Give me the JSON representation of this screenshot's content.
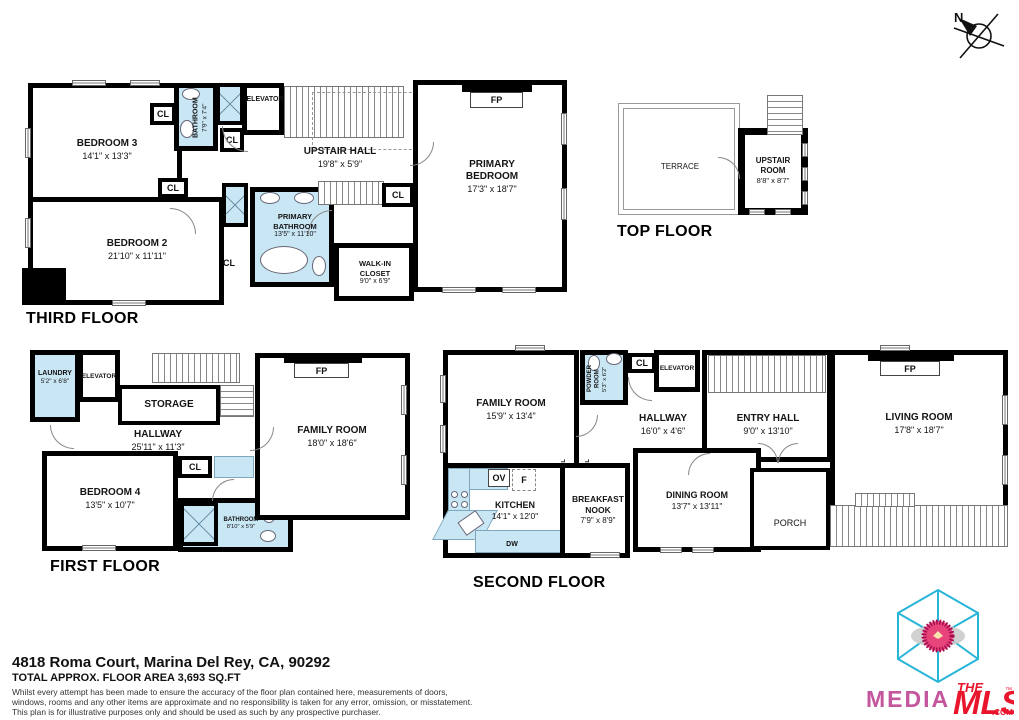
{
  "compass": {
    "label": "N"
  },
  "labels": {
    "cl": "CL",
    "fp": "FP",
    "ov": "OV",
    "f": "F",
    "dw": "DW"
  },
  "floors": {
    "third": {
      "title": "THIRD FLOOR",
      "rooms": {
        "bedroom3": {
          "name": "BEDROOM 3",
          "dims": "14'1\" x 13'3\""
        },
        "bathroom": {
          "name": "BATHROOM",
          "dims": "7'9\" x 7'4\""
        },
        "elevator": {
          "name": "ELEVATOR"
        },
        "upstair_hall": {
          "name": "UPSTAIR HALL",
          "dims": "19'8\" x 5'9\""
        },
        "primary_bedroom": {
          "name": "PRIMARY BEDROOM",
          "dims": "17'3\" x 18'7\""
        },
        "bedroom2": {
          "name": "BEDROOM 2",
          "dims": "21'10\" x 11'11\""
        },
        "primary_bathroom": {
          "name": "PRIMARY BATHROOM",
          "dims": "13'5\" x 11'10\""
        },
        "walkin_closet": {
          "name": "WALK-IN CLOSET",
          "dims": "9'0\" x 6'9\""
        }
      }
    },
    "top": {
      "title": "TOP FLOOR",
      "rooms": {
        "terrace": {
          "name": "TERRACE"
        },
        "upstair_room": {
          "name": "UPSTAIR ROOM",
          "dims": "8'8\" x 8'7\""
        }
      }
    },
    "first": {
      "title": "FIRST FLOOR",
      "rooms": {
        "laundry": {
          "name": "LAUNDRY",
          "dims": "5'2\" x 6'8\""
        },
        "elevator": {
          "name": "ELEVATOR"
        },
        "storage": {
          "name": "STORAGE"
        },
        "hallway": {
          "name": "HALLWAY",
          "dims": "25'11\" x 11'3\""
        },
        "bedroom4": {
          "name": "BEDROOM 4",
          "dims": "13'5\" x 10'7\""
        },
        "bathroom": {
          "name": "BATHROOM",
          "dims": "8'10\" x 5'9\""
        },
        "family_room": {
          "name": "FAMILY ROOM",
          "dims": "18'0\" x 18'6\""
        }
      }
    },
    "second": {
      "title": "SECOND FLOOR",
      "rooms": {
        "family_room": {
          "name": "FAMILY ROOM",
          "dims": "15'9\" x 13'4\""
        },
        "powder_room": {
          "name": "POWDER ROOM",
          "dims": "5'3\" x 6'2\""
        },
        "elevator": {
          "name": "ELEVATOR"
        },
        "hallway": {
          "name": "HALLWAY",
          "dims": "16'0\" x 4'6\""
        },
        "entry_hall": {
          "name": "ENTRY HALL",
          "dims": "9'0\" x 13'10\""
        },
        "living_room": {
          "name": "LIVING ROOM",
          "dims": "17'8\" x 18'7\""
        },
        "kitchen": {
          "name": "KITCHEN",
          "dims": "14'1\" x 12'0\""
        },
        "breakfast_nook": {
          "name": "BREAKFAST NOOK",
          "dims": "7'9\" x 8'9\""
        },
        "dining_room": {
          "name": "DINING ROOM",
          "dims": "13'7\" x 13'11\""
        },
        "porch": {
          "name": "PORCH"
        }
      }
    }
  },
  "footer": {
    "address": "4818 Roma Court, Marina Del Rey, CA, 90292",
    "area": "TOTAL APPROX. FLOOR AREA 3,693 SQ.FT",
    "disclaimer1": "Whilst every attempt has been made to ensure the accuracy of the floor plan contained here, measurements of doors,",
    "disclaimer2": "windows, rooms and any other items are approximate and no responsibility is taken for any error, omission, or misstatement.",
    "disclaimer3": "This plan is for illustrative purposes only and should be used as such by any prospective purchaser."
  },
  "logo": {
    "media": "MEDIA",
    "the": "THE",
    "mls": "MLS",
    "com": ".COM",
    "tm": "™"
  },
  "colors": {
    "wall": "#000000",
    "wet_fill": "#c9e6f5",
    "cyan": "#29b5d8",
    "pink": "#c4569e",
    "red": "#e8152d"
  }
}
